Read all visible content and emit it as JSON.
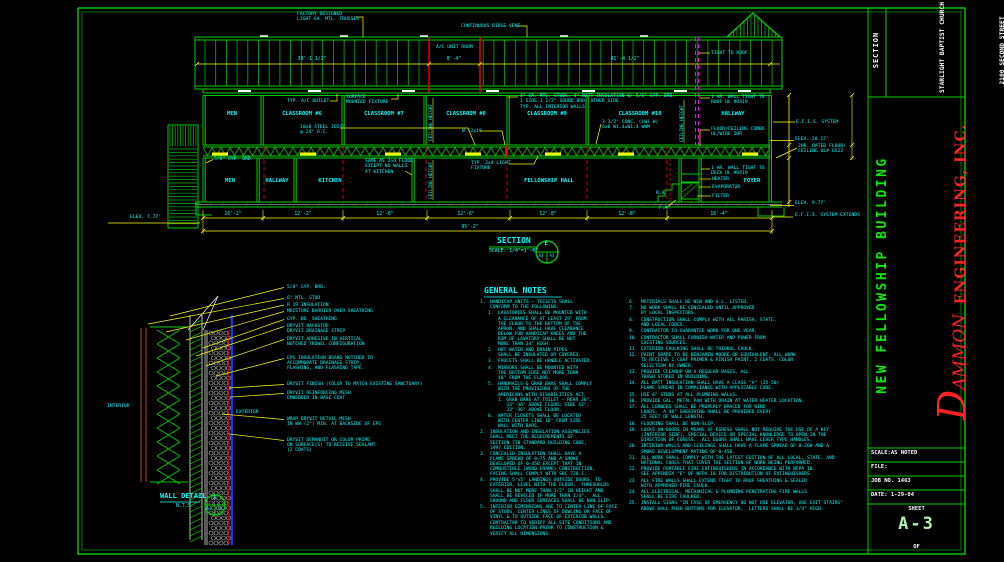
{
  "title_block": {
    "section_label": "SECTION",
    "project": [
      "STARLIGHT BAPTIST CHURCH",
      "2100 SECOND STREET",
      "SLIDELL, LOUISIANA"
    ],
    "building_name": "NEW FELLOWSHIP BUILDING",
    "firm_initial": "D",
    "firm_rest": "AMMON",
    "firm_name": "ENGINEERING, INC.",
    "firm_address": "SLIDELL, LOUISIANA",
    "scale_row": "SCALE:AS NOTED",
    "file_row": "FILE:",
    "job_row": "JOB NO. 1463",
    "date_row": "DATE: 1-29-04",
    "sheet_word": "SHEET",
    "sheet_no": "A-3",
    "of_label": "OF"
  },
  "section": {
    "title": "SECTION",
    "scale": "SCALE: 1/4\"=1'-0\"",
    "marker": {
      "top": "E",
      "left": "A3",
      "right": "A3"
    },
    "rooms_second": [
      "MEN",
      "CLASSROOM #6",
      "CLASSROOM #7",
      "CLASSROOM #8",
      "CLASSROOM #9",
      "CLASSROOM #10",
      "HALLWAY"
    ],
    "rooms_first": [
      "MEN",
      "HALLWAY",
      "KITCHEN",
      "FELLOWSHIP HALL",
      "FOYER"
    ],
    "dims_roof": [
      "30'-1 1/2\"",
      "8'-4\"",
      "41'-4 1/2\""
    ],
    "dims_bottom": [
      "16'-2\"",
      "12'-2\"",
      "12'-8\"",
      "12'-6\"",
      "12'-8\"",
      "12'-8\"",
      "16'-4\""
    ],
    "dim_overall": "95'-2\"",
    "ann": {
      "factory": "FACTORY DESIGNED\nLIGHT GA. MTL. TRUSSES",
      "ridge": "CONTINUOUS RIDGE VENT",
      "ac_room": "A/C UNIT ROOM",
      "tight_roof": "TIGHT TO ROOF",
      "hr_wall_roof": "1 HR. WALL TIGHT TO\nROOF UL #U419",
      "studs_note": "4\" GA. MTL. STUDS, 4\" BATT INSULATION W/ 5/8\" GYP. BRD.\n1 SIDE 3 1/2\" SOUND BRD. OTHER SIDE\nTYP. ALL INTERIOR WALLS",
      "ac_outlet": "TYP. A/C OUTLET",
      "surf_fix": "SURFACE\nMOUNTED FIXTURE",
      "joist": "10x8 STEEL JOIST\n@ 24\" O.C.",
      "wbeam": "W 12x19",
      "conc": "3 1/2\" CONC. (LW) W/\n6x6 W1.4xW1.4 WWM",
      "fc_combo": "FLOOR/CEILING COMBO\nUL/WIRE 2HR",
      "ceiling_height": "CEILING HEIGHT",
      "gyp_1f": "5/8\" GYP. BRD.",
      "same_as": "SAME AS 2nd FLOOR\nEXCEPT NO WALLS\nAT KITCHEN",
      "light_fix": "TYP. 2x4 LIGHT\nFIXTURE",
      "hr_wall_deck": "1 HR. WALL TIGHT TO\nDECK UL #U419",
      "heater": "HEATER",
      "evaporator": "EVAPORATOR",
      "filter": "FILTER",
      "ra": "R.A.",
      "fa": "F.A.",
      "efis": "E.F.I.S. SYSTEM",
      "elev_mid": "ELEV. 20.17'",
      "rated_fc": "2HR. RATED FLOOR/\nCEILING UL# G512",
      "elev_right": "ELEV. 9.77'",
      "efis_ext": "E.F.I.S. SYSTEM EXTENDS",
      "elev_left": "ELEV. 7.77'"
    }
  },
  "wall_detail": {
    "title": "WALL DETAIL",
    "scale": "N.T.S.",
    "marker": {
      "top": "2",
      "left": "A3",
      "right": "A3"
    },
    "interior": "INTERIOR",
    "exterior": "EXTERIOR",
    "labels": [
      "5/8\" GYP. BRD.",
      "6\" MTL. STUD",
      "R 19 INSULATION",
      "MOISTURE BARRIER OVER SHEATHING",
      "GYP. BD. SHEATHING",
      "DRYVIT BACKSTOP\nDRYVIT DRAINAGE STRIP",
      "DRYVIT ADHESIVE IN VERTICAL\nNOTCHED TROWEL CONFIGURATION",
      "EPS INSULATION BOARD NOTCHED TO\nACCOMMODATE DRAINAGE STRIP,\nFLASHING, AND FLASHING TAPE.",
      "DRYVIT FINISH (COLOR TO MATCH EXISTING SANCTUARY)",
      "DRYVIT REINFORCING MESH\nEMBEDDED IN BASE COAT",
      "WRAP DRYVIT DETAIL MESH\nIN WW (2\") MIN. AT BACKSIDE OF EPS",
      "DRYVIT DEMANDIT OR COLOR PRIME\nON SURFACE(S) TO RECEIVE SEALANT\n(2 COATS)"
    ]
  },
  "general_notes": {
    "title": "GENERAL NOTES",
    "col1": [
      {
        "n": "1.",
        "i": 0,
        "t": [
          "HANDICAP UNITS — TOILETS SHALL",
          "CONFORM TO THE FOLLOWING:"
        ]
      },
      {
        "n": "1.",
        "i": 1,
        "t": [
          "LAVATORIES SHALL BE MOUNTED WITH",
          "A CLEARANCE OF AT LEAST 29\" FROM",
          "THE FLOOR TO THE BOTTOM OF THE",
          "APRON, AND SHALL HAVE CLEARANCE",
          "BELOW FOR HANDICAP KNEES AND THE",
          "RIM OF LAVATORY SHALL BE NOT",
          "MORE THAN 34\" HIGH."
        ]
      },
      {
        "n": "2.",
        "i": 1,
        "t": [
          "HOT WATER AND DRAIN PIPES",
          "SHALL BE INSULATED OR COVERED."
        ]
      },
      {
        "n": "3.",
        "i": 1,
        "t": [
          "FAUCETS SHALL BE HANDLE ACTIVATED."
        ]
      },
      {
        "n": "4.",
        "i": 1,
        "t": [
          "MIRRORS SHALL BE MOUNTED WITH",
          "THE BOTTOM EDGE NOT MORE THAN",
          "40\" FROM THE FLOOR."
        ]
      },
      {
        "n": "5.",
        "i": 1,
        "t": [
          "HANDRAILS & GRAB BARS SHALL COMPLY",
          "WITH THE PROVISIONS OF THE",
          "AMERICANS WITH DISABILITIES ACT.",
          "1. GRAB BARS AT TOILET — REAR 36\",",
          "   33\"-36\" ABOVE FLOOR; SIDE 42\",",
          "   33\"-36\" ABOVE FLOOR."
        ]
      },
      {
        "n": "6.",
        "i": 1,
        "t": [
          "WATER CLOSETS SHALL BE LOCATED",
          "WITH CENTER LINE 18\" FROM SIDE",
          "WALL WITH BARS."
        ]
      },
      {
        "n": "2.",
        "i": 0,
        "t": [
          "INSULATION AND INSULATION ASSEMBLIES",
          "SHALL MEET THE REQUIREMENTS OF",
          "SECTION 720 STANDARD BUILDING CODE,",
          "1997 EDITION."
        ]
      },
      {
        "n": "3.",
        "i": 0,
        "t": [
          "CONCEALED INSULATION SHALL HAVE A",
          "FLAME SPREAD OF 0-75 AND A SMOKE",
          "DEVELOPED OF 0-450 EXCEPT THAT IN",
          "COMBUSTIBLE (WOOD FRAME) CONSTRUCTION,",
          "FACING SHALL COMPLY WITH SBC 720.1."
        ]
      },
      {
        "n": "4.",
        "i": 0,
        "t": [
          "PROVIDE 5'x5' LANDINGS OUTSIDE DOORS, TO",
          "EXTERIOR, LEVEL WITH THE FLOOR.  THRESHOLDS",
          "SHALL BE NOT MORE THAN 1/2\" IN HEIGHT AND",
          "SHALL BE BEVELED IF MORE THAN 1/4\".  ALL",
          "GROUND AND FLOOR SURFACES SHALL BE NON SLIP."
        ]
      },
      {
        "n": "5.",
        "i": 0,
        "t": [
          "INTERIOR DIMENSIONS ARE TO CENTER LINE OF FACE",
          "OF STUDS, CENTER LINES OF DOWLING OR FACE OF",
          "VINYL & TO OUTSIDE FACE OF EXTERIOR WALLS."
        ]
      },
      {
        "n": "",
        "i": 0,
        "t": [
          "CONTRACTOR TO VERIFY ALL SITE CONDITIONS AND",
          "BUILDING LOCATION PRIOR TO CONSTRUCTION &",
          "VERIFY ALL DIMENSIONS."
        ]
      }
    ],
    "col2": [
      {
        "n": "6.",
        "i": 0,
        "t": [
          "MATERIALS SHALL BE NEW AND U.L. LISTED."
        ]
      },
      {
        "n": "7.",
        "i": 0,
        "t": [
          "NO WORK SHALL BE CONCEALED UNTIL APPROVED",
          "BY LOCAL INSPECTORS."
        ]
      },
      {
        "n": "8.",
        "i": 0,
        "t": [
          "CONSTRUCTION SHALL COMPLY WITH ALL PARISH, STATE,",
          "AND LOCAL CODES."
        ]
      },
      {
        "n": "9.",
        "i": 0,
        "t": [
          "CONTRACTOR TO GUARANTEE WORK FOR ONE YEAR."
        ]
      },
      {
        "n": "10.",
        "i": 0,
        "t": [
          "CONTRACTOR SHALL FURNISH WATER AND POWER FROM",
          "EXISTING SOURCES."
        ]
      },
      {
        "n": "11.",
        "i": 0,
        "t": [
          "EXTERIOR CAULKING SHALL BE THIOKOL CAULK."
        ]
      },
      {
        "n": "12.",
        "i": 0,
        "t": [
          "PAINT GRADE TO BE BENJAMIN MOORE OR EQUIVALENT. ALL WORK",
          "TO RECEIVE 1 COAT PRIMER & FINISH PAINT, 2 COATS. COLOR",
          "SELECTION BY OWNER."
        ]
      },
      {
        "n": "13.",
        "i": 0,
        "t": [
          "PROVIDE CLEANUP ON A REGULAR BASIS. ALL",
          "TRASH STORED IN BUILDING."
        ]
      },
      {
        "n": "14.",
        "i": 0,
        "t": [
          "ALL BATT INSULATION SHALL HAVE A CLASS \"A\" (25-50)",
          "FLAME SPREAD IN COMPLIANCE WITH APPLICABLE CODE."
        ]
      },
      {
        "n": "15.",
        "i": 0,
        "t": [
          "USE 6\" STUDS AT ALL PLUMBING WALLS."
        ]
      },
      {
        "n": "16.",
        "i": 0,
        "t": [
          "PROVIDE GAL. METAL PAN WITH DRAIN AT WATER HEATER LOCATION."
        ]
      },
      {
        "n": "17.",
        "i": 0,
        "t": [
          "ALL CORNERS SHALL BE PROPERLY BRACED FOR WIND",
          "LOADS.  A 48\" SHEATHING SHALL BE PROVIDED EVERY",
          "25 FEET OF WALL LENGTH."
        ]
      },
      {
        "n": "18.",
        "i": 0,
        "t": [
          "FLOORING SHALL BE NON-SLIP."
        ]
      },
      {
        "n": "19.",
        "i": 0,
        "t": [
          "LOCKS ON DOORS IN MEANS OF EGRESS SHALL NOT REQUIRE THE USE OF A KEY",
          "(INTERIOR SIDE), SPECIAL DEVICE OR SPECIAL KNOWLEDGE TO OPEN IN THE",
          "DIRECTION OF EGRESS.  ALL DOORS SHALL HAVE LEVER TYPE HANDLES."
        ]
      },
      {
        "n": "20.",
        "i": 0,
        "t": [
          "INTERIOR WALLS AND CEILINGS SHALL HAVE A FLAME SPREAD OF 0-200 AND A",
          "SMOKE DEVELOPMENT RATING OF 0-450."
        ]
      },
      {
        "n": "21.",
        "i": 0,
        "t": [
          "ALL WORK SHALL COMPLY WITH THE LATEST EDITION OF ALL LOCAL, STATE, AND",
          "NATIONAL CODES THAT COVER THE SECTION OF WORK BEING PERFORMED."
        ]
      },
      {
        "n": "22.",
        "i": 0,
        "t": [
          "PROVIDE PORTABLE FIRE EXTINGUISHERS IN ACCORDANCE WITH NFPA 10.",
          "SEE APPENDIX \"E\" OF NFPA 10 FOR DISTRIBUTION OF EXTINGUISHERS."
        ]
      },
      {
        "n": "23.",
        "i": 0,
        "t": [
          "ALL FIRE WALLS SHALL EXTEND TIGHT TO ROOF SHEATHING & SEALED",
          "WITH APPROVED FIRE CAULK."
        ]
      },
      {
        "n": "24.",
        "i": 0,
        "t": [
          "ALL ELECTRICAL, MECHANICAL & PLUMBING PENETRATING FIRE WALLS",
          "SHALL BE FIRE CAULKED."
        ]
      },
      {
        "n": "25.",
        "i": 0,
        "t": [
          "INSTALL SIGNS \"IN CASE OF EMERGENCY DO NOT USE ELEVATOR, USE EXIT STAIRS\"",
          "ABOVE HALL PUSH BUTTONS FOR ELEVATOR.  LETTERS SHALL BE 3/4\" HIGH."
        ]
      }
    ]
  }
}
